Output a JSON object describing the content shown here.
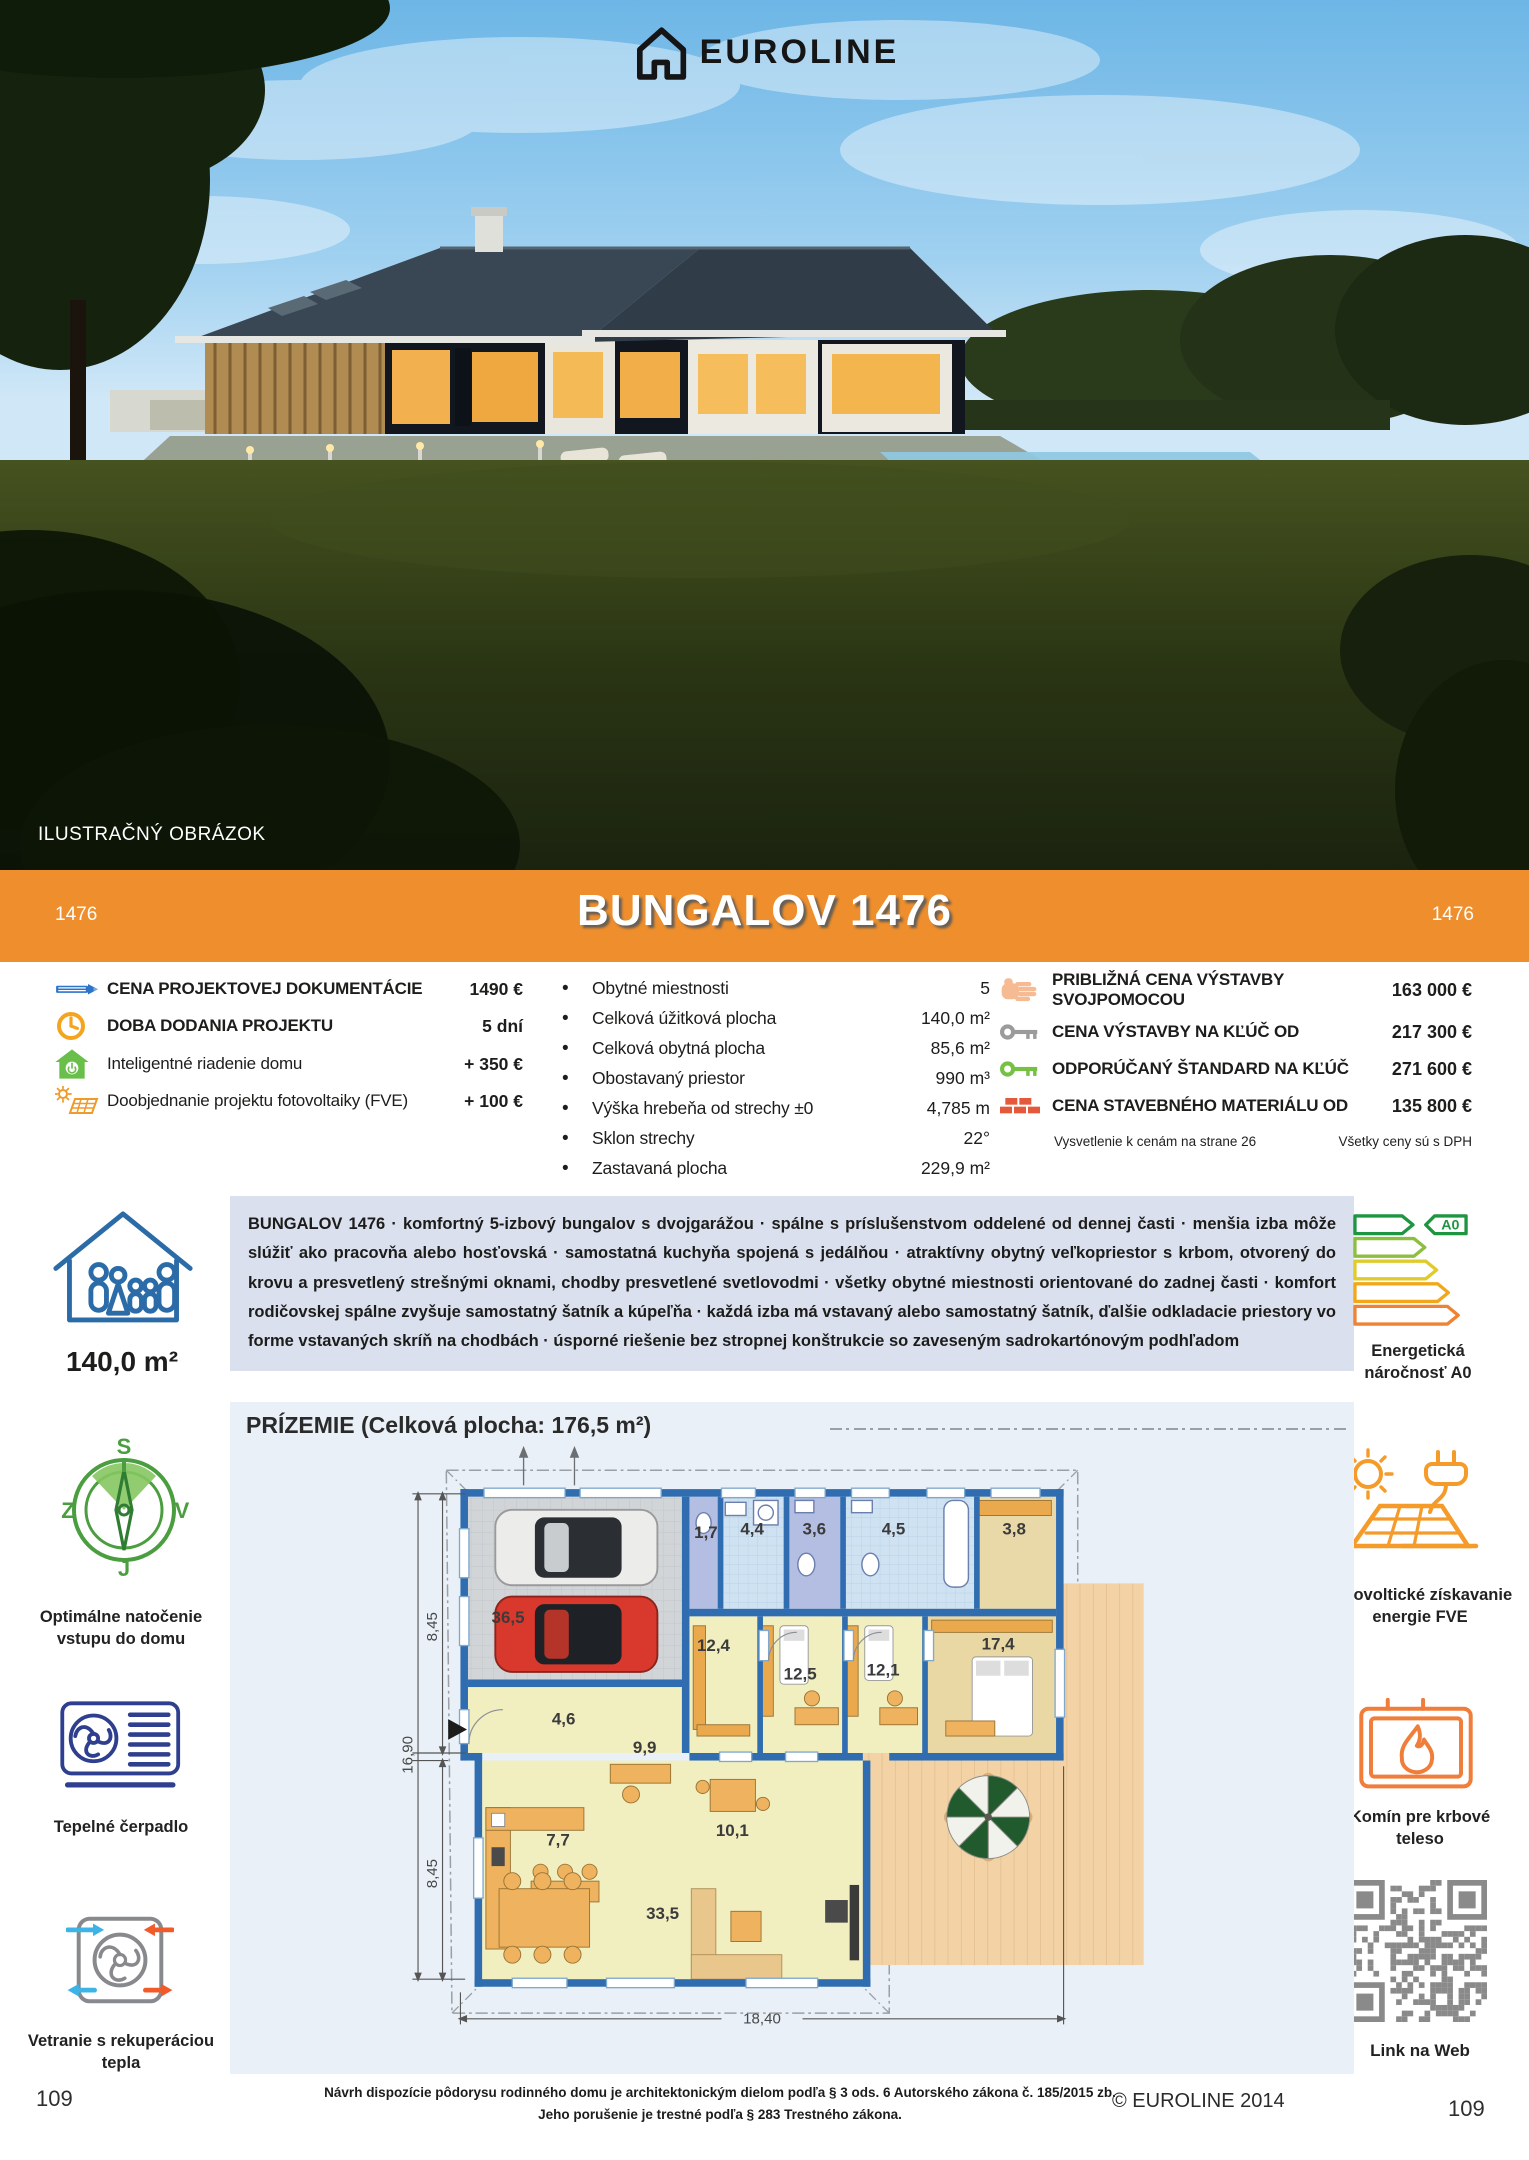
{
  "logo": {
    "brand": "EUROLINE"
  },
  "photo": {
    "caption": "ILUSTRAČNÝ OBRÁZOK"
  },
  "banner": {
    "title": "BUNGALOV 1476",
    "code_left": "1476",
    "code_right": "1476"
  },
  "specs": {
    "left": [
      {
        "icon": "pencil-icon",
        "label": "CENA PROJEKTOVEJ DOKUMENTÁCIE",
        "value": "1490 €"
      },
      {
        "icon": "clock-icon",
        "label": "DOBA DODANIA PROJEKTU",
        "value": "5 dní"
      },
      {
        "icon": "smart-home-icon",
        "label": "Inteligentné riadenie domu",
        "value": "+ 350 €"
      },
      {
        "icon": "solar-addon-icon",
        "label": "Doobjednanie projektu fotovoltaiky (FVE)",
        "value": "+ 100 €"
      }
    ],
    "middle": [
      {
        "label": "Obytné miestnosti",
        "value": "5"
      },
      {
        "label": "Celková úžitková plocha",
        "value": "140,0 m²"
      },
      {
        "label": "Celková obytná plocha",
        "value": "85,6 m²"
      },
      {
        "label": "Obostavaný priestor",
        "value": "990 m³"
      },
      {
        "label": "Výška hrebeňa od strechy ±0",
        "value": "4,785 m"
      },
      {
        "label": "Sklon strechy",
        "value": "22°"
      },
      {
        "label": "Zastavaná plocha",
        "value": "229,9 m²"
      }
    ],
    "right": [
      {
        "icon": "hand-icon",
        "label": "PRIBLIŽNÁ CENA VÝSTAVBY SVOJPOMOCOU",
        "value": "163 000 €"
      },
      {
        "icon": "key-gray-icon",
        "label": "CENA VÝSTAVBY NA KĽÚČ OD",
        "value": "217 300 €"
      },
      {
        "icon": "key-green-icon",
        "label": "ODPORÚČANÝ ŠTANDARD NA KĽÚČ",
        "value": "271 600 €"
      },
      {
        "icon": "bricks-icon",
        "label": "CENA STAVEBNÉHO MATERIÁLU OD",
        "value": "135 800 €"
      }
    ],
    "footnote_left": "Vysvetlenie k cenám na strane 26",
    "footnote_right": "Všetky ceny sú s DPH"
  },
  "description": {
    "text": "BUNGALOV 1476 · komfortný 5-izbový bungalov s dvojgarážou · spálne s príslušenstvom oddelené od dennej časti · menšia izba môže slúžiť ako pracovňa alebo hosťovská · samostatná kuchyňa spojená s jedálňou · atraktívny obytný veľkopriestor s krbom, otvorený do krovu a presvetlený strešnými oknami, chodby presvetlené svetlovodmi · všetky obytné miestnosti orientované do zadnej časti · komfort rodičovskej spálne zvyšuje samostatný šatník a kúpeľňa · každá izba má vstavaný alebo samostatný šatník, ďalšie odkladacie priestory vo forme vstavaných skríň na chodbách · úsporné riešenie bez stropnej konštrukcie so zaveseným sadrokartónovým podhľadom"
  },
  "sidebar_left": {
    "area": "140,0 m²",
    "compass": {
      "n": "S",
      "w": "Z",
      "e": "V",
      "s": "J"
    },
    "compass_label": "Optimálne natočenie vstupu do domu",
    "heatpump_label": "Tepelné čerpadlo",
    "ventilation_label": "Vetranie s rekuperáciou tepla",
    "page_number": "109"
  },
  "sidebar_right": {
    "energy_badge": "A0",
    "energy_label": "Energetická náročnosť A0",
    "pv_label": "Fotovoltické získavanie energie FVE",
    "chimney_label": "Komín pre krbové teleso",
    "qr_label": "Link na Web",
    "page_number": "109"
  },
  "floorplan": {
    "title": "PRÍZEMIE (Celková plocha: 176,5 m²)",
    "rooms": {
      "garage": "36,5",
      "wc1": "1,7",
      "bath1": "4,4",
      "wc2": "3,6",
      "bath2": "4,5",
      "wardrobe": "3,8",
      "hall": "12,4",
      "bedroom1": "12,5",
      "bedroom2": "12,1",
      "master": "17,4",
      "entry": "4,6",
      "study": "9,9",
      "dining": "10,1",
      "kitchen": "7,7",
      "living": "33,5"
    },
    "dims": {
      "height_top": "8,45",
      "height_total": "16,90",
      "height_bottom": "8,45",
      "width": "18,40"
    }
  },
  "footer": {
    "legal_line1": "Návrh dispozície pôdorysu rodinného domu je architektonickým dielom podľa § 3 ods. 6 Autorského zákona č. 185/2015 zb.",
    "legal_line2": "Jeho porušenie je trestné podľa § 283 Trestného zákona.",
    "copyright": "© EUROLINE 2014"
  }
}
